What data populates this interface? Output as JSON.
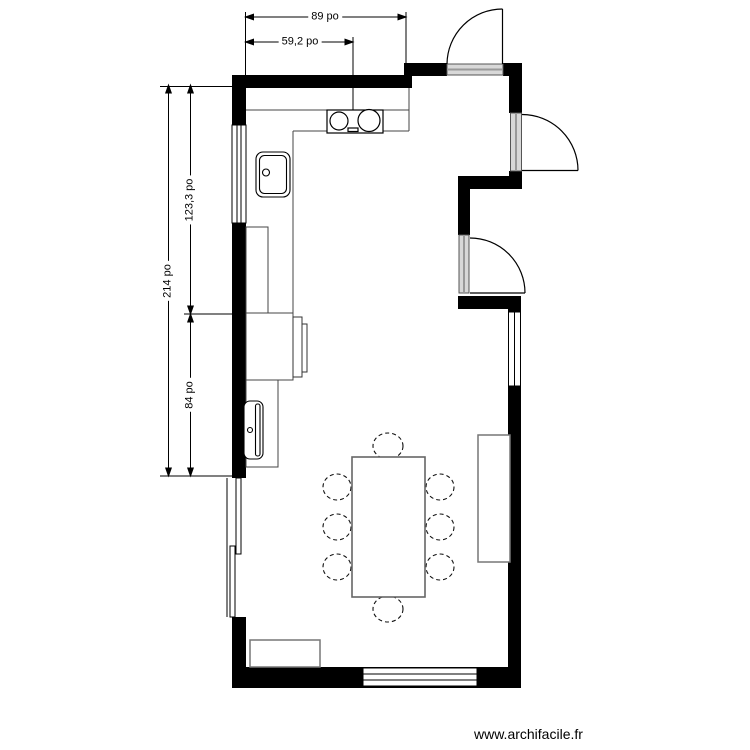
{
  "dimensions": {
    "top_width": "89 po",
    "top_partial": "59,2 po",
    "left_total": "214 po",
    "left_upper": "123,3 po",
    "left_lower": "84 po",
    "unit": "po"
  },
  "watermark": "www.archifacile.fr",
  "plan": {
    "colors": {
      "wall": "#000000",
      "dimension_line": "#000000",
      "furniture_border": "#777777",
      "door_sill": "#d8d8d8",
      "chair_outline": "#111111"
    },
    "objects": {
      "doors": 3,
      "windows": 3,
      "sliding_door": 1,
      "chairs": 8,
      "items": [
        "kitchen-counter",
        "wall-cabinet-line",
        "sink",
        "cooktop",
        "tall-cabinet",
        "appliance-door",
        "base-cabinet",
        "dining-table",
        "chair",
        "sideboard",
        "bench"
      ]
    }
  }
}
